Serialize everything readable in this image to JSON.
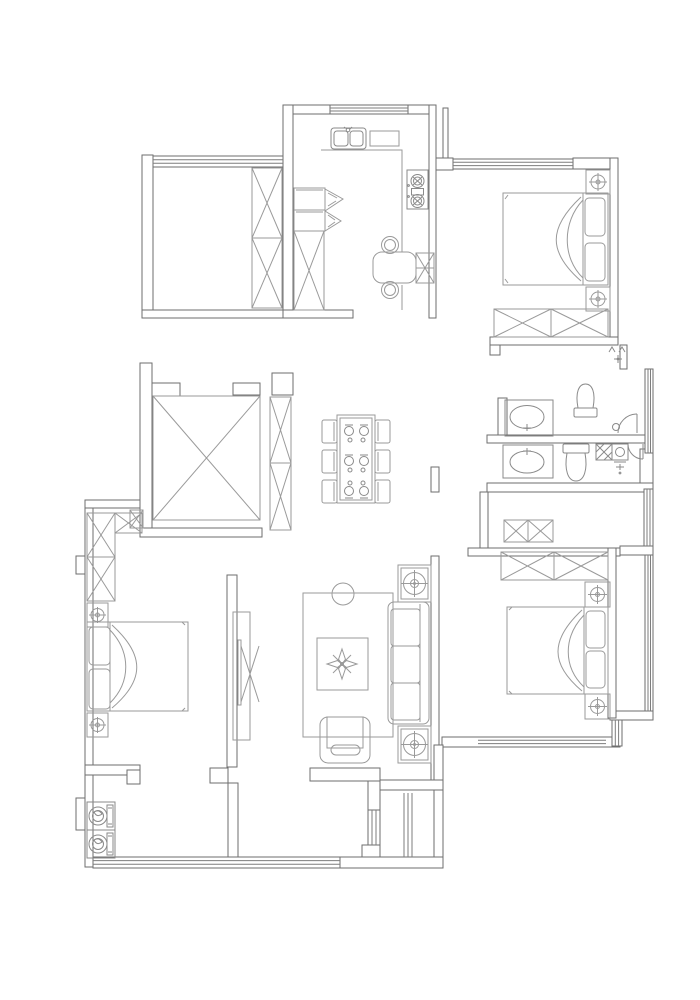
{
  "document": {
    "type": "architectural-floor-plan",
    "style": "CAD monochrome line drawing, no text labels visible",
    "orientation": "portrait"
  },
  "colors": {
    "background": "#ffffff",
    "wall_line": "#6e6e6e",
    "window_line": "#7d7d7d",
    "furniture_line": "#9a9a9a",
    "fixture_line": "#8a8a8a"
  },
  "rooms": [
    {
      "id": "balcony-northwest",
      "role": "storage-balcony",
      "features": [
        "window-band-west",
        "tall-wardrobe-2-sections"
      ]
    },
    {
      "id": "kitchen",
      "role": "kitchen",
      "features": [
        "double-bowl-sink",
        "counter-top",
        "gas-stove-2-burner",
        "refrigerator-cabinet-with-door-swings",
        "tall-crossed-cabinet",
        "breakfast-table",
        "two-round-chairs",
        "side-crossed-cabinet",
        "window-north"
      ]
    },
    {
      "id": "bedroom-northeast",
      "role": "bedroom",
      "features": [
        "double-bed-head-east",
        "two-pillows",
        "nightstand-lamp-north",
        "nightstand-lamp-south",
        "wardrobe-2-sections",
        "window-north"
      ]
    },
    {
      "id": "entry-east",
      "role": "entrance-hall",
      "features": [
        "entry-threshold-marks",
        "window-east"
      ]
    },
    {
      "id": "bathroom-upper",
      "role": "bathroom",
      "features": [
        "vanity-oval-basin",
        "toilet-facing-south",
        "door-swing-arc"
      ]
    },
    {
      "id": "bathroom-lower",
      "role": "bathroom",
      "features": [
        "vanity-oval-basin",
        "toilet-facing-north",
        "hatched-shower-drain",
        "small-basin-cabinet",
        "door-swing-arc",
        "faucet-marks"
      ]
    },
    {
      "id": "dining-center",
      "role": "dining-area",
      "features": [
        "dining-table-6-seats",
        "six-chairs",
        "six-place-settings"
      ]
    },
    {
      "id": "shaft-center-west",
      "role": "void-shaft",
      "features": [
        "crossed-square-void",
        "tall-shelving-2-sections",
        "small-crossed-box"
      ]
    },
    {
      "id": "bedroom-southwest",
      "role": "bedroom",
      "features": [
        "double-bed-head-west",
        "two-pillows",
        "nightstand-lamp-north",
        "nightstand-lamp-south",
        "l-shaped-wardrobe-3-sections",
        "tv-panel-on-partition"
      ]
    },
    {
      "id": "living-south-center",
      "role": "living-room",
      "features": [
        "area-rug",
        "round-side-table",
        "coffee-table-with-plant-motif",
        "sofa-3-cushions-back-east",
        "end-table-lamp-north",
        "end-table-lamp-south",
        "armchair-facing-north"
      ]
    },
    {
      "id": "bedroom-southeast",
      "role": "bedroom",
      "features": [
        "double-bed-head-east",
        "two-pillows",
        "nightstand-lamp-north",
        "nightstand-lamp-south",
        "wardrobe-2-sections",
        "small-cabinet-2-sections",
        "window-east",
        "window-south"
      ]
    },
    {
      "id": "balcony-south",
      "role": "laundry-balcony",
      "features": [
        "washing-machine-upper",
        "washing-machine-lower",
        "window-band-south"
      ]
    },
    {
      "id": "utility-shaft-south",
      "role": "flue-shaft",
      "features": [
        "vent-line-triplet"
      ]
    }
  ]
}
